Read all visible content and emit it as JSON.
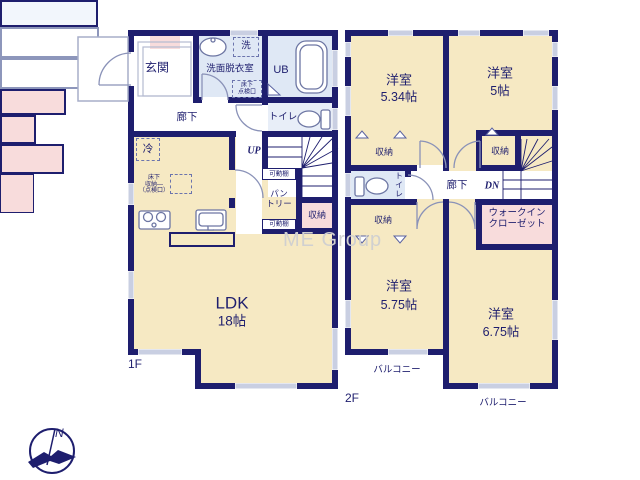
{
  "meta": {
    "watermark": "ME Group",
    "compass_north": "N"
  },
  "colors": {
    "wall": "#1e1e6e",
    "room_cream": "#f6e9c3",
    "wet_blue": "#dfe8f5",
    "storage_pink": "#f8dcdc",
    "window_band": "#c9cfe2"
  },
  "f1": {
    "label": "1F",
    "genkan": "玄関",
    "rouka": "廊下",
    "senmen": "洗面脱衣室",
    "laundry": "洗",
    "tenken_line1": "床下",
    "tenken_line2": "点検口",
    "ub": "UB",
    "toilet": "トイレ",
    "up": "UP",
    "rei": "冷",
    "yuka_line1": "床下",
    "yuka_line2": "収納―",
    "yuka_line3": "（点検口）",
    "kadodana_top": "可動棚",
    "pantry_line1": "パン",
    "pantry_line2": "トリー",
    "kadodana_btm": "可動棚",
    "shuno": "収納",
    "ldk": "LDK",
    "ldk_size": "18帖"
  },
  "f2": {
    "label": "2F",
    "r534": "洋室",
    "r534_size": "5.34帖",
    "r5": "洋室",
    "r5_size": "5帖",
    "r575": "洋室",
    "r575_size": "5.75帖",
    "r675": "洋室",
    "r675_size": "6.75帖",
    "shuno_a": "収納",
    "shuno_b": "収納",
    "shuno_c": "収納",
    "toilet": "トイレ",
    "rouka": "廊下",
    "dn": "DN",
    "wic_line1": "ウォークイン",
    "wic_line2": "クローゼット",
    "balcony_l": "バルコニー",
    "balcony_r": "バルコニー"
  }
}
